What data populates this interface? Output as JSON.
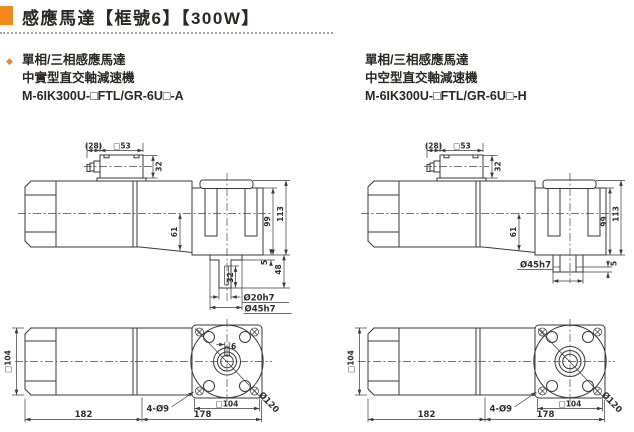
{
  "header": {
    "title": "感應馬達【框號6】【300W】",
    "accent_color": "#F08A1E"
  },
  "sections": {
    "left": {
      "bullet": "◆",
      "line1": "單相/三相感應馬達",
      "line2": "中實型直交軸減速機",
      "model": "M-6IK300U-□FTL/GR-6U□-A"
    },
    "right": {
      "line1": "單相/三相感應馬達",
      "line2": "中空型直交軸減速機",
      "model": "M-6IK300U-□FTL/GR-6U□-H"
    }
  },
  "drawings": {
    "solid_side": {
      "d28": "(28)",
      "d53": "□53",
      "d32_box": "32",
      "d61": "61",
      "d99": "99",
      "d113": "113",
      "d5": "5",
      "d48": "48",
      "d32_shaft": "32",
      "shaft_dia": "Ø20h7",
      "boss_dia": "Ø45h7"
    },
    "hollow_side": {
      "d28": "(28)",
      "d53": "□53",
      "d32_box": "32",
      "d61": "61",
      "d99": "99",
      "d113": "113",
      "d5": "5",
      "boss_dia": "Ø45h7"
    },
    "solid_top": {
      "sq104_body": "□104",
      "d182": "182",
      "d178": "178",
      "holes": "4-Ø9",
      "sq104_flange": "□104",
      "pilot_dia": "Ø120",
      "key_width": "6"
    },
    "hollow_top": {
      "sq104_body": "□104",
      "d182": "182",
      "d178": "178",
      "holes": "4-Ø9",
      "sq104_flange": "□104",
      "pilot_dia": "Ø120"
    }
  }
}
